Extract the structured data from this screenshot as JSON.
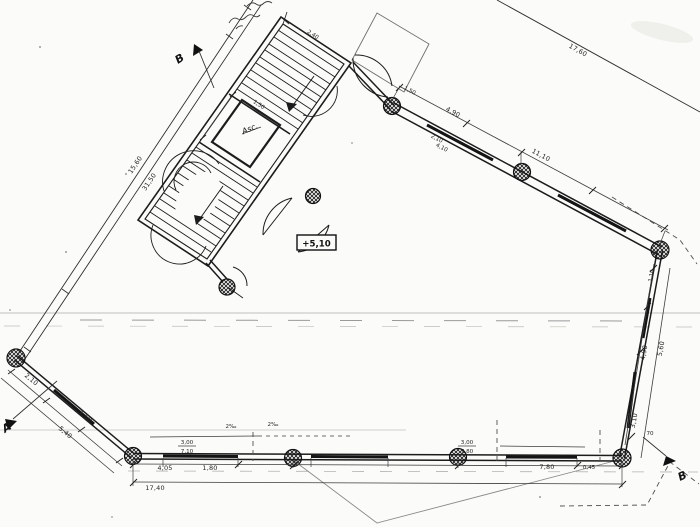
{
  "colors": {
    "paper": "#fbfbf9",
    "ink": "#1c1c1c",
    "thin": "#3c3c3c",
    "faint": "#9b9b9b"
  },
  "annotations": {
    "level_marker": "+5,10",
    "elevator_label": "Asc.",
    "section_top": "B",
    "section_left": "A",
    "section_bottom_right": "B"
  },
  "dimensions": {
    "property_left_upper": "15,60",
    "property_left_total": "31,50",
    "property_top_right": "17,60",
    "top_wall_span_1": "4,90",
    "top_wall_span_2": "11,10",
    "top_wall_mullion": "1,50",
    "top_wall_stack_a": "2,10",
    "top_wall_stack_b": "4,10",
    "right_wall_top": "1,10",
    "right_wall_span_inner": "4,90",
    "right_wall_span_outer": "5,60",
    "right_wall_lower": "3,10",
    "right_wall_corner": "70",
    "bottom_span_1": "4,05",
    "bottom_span_2": "1,80",
    "bottom_span_3": "7,80",
    "bottom_span_4": "0,45",
    "bottom_total": "17,40",
    "bottom_stack_left_a": "3,00",
    "bottom_stack_left_b": "7,10",
    "bottom_stack_right_a": "3,00",
    "bottom_stack_right_b": "7,80",
    "slope_mark_a": "2‰",
    "slope_mark_b": "2‰",
    "left_wall_span_1": "2,10",
    "left_wall_span_2": "1,50",
    "left_wall_total": "5,40",
    "stair_block_top": "2,40",
    "elevator_width": "1,50"
  }
}
